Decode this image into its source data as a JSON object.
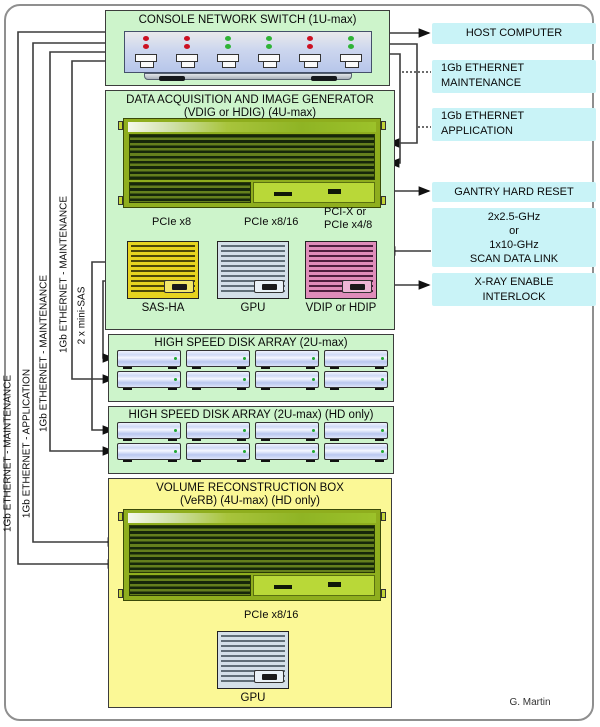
{
  "console_switch": {
    "title": "CONSOLE NETWORK SWITCH (1U-max)",
    "ports": [
      "red",
      "red",
      "green",
      "green",
      "red",
      "green"
    ]
  },
  "daq": {
    "title": "DATA ACQUISITION AND IMAGE GENERATOR",
    "subtitle": "(VDIG or HDIG) (4U-max)",
    "bus_sas": "PCIe x8",
    "bus_gpu": "PCIe x8/16",
    "bus_vdip_1": "PCI-X or",
    "bus_vdip_2": "PCIe x4/8",
    "card_sas": "SAS-HA",
    "card_gpu": "GPU",
    "card_vdip": "VDIP or HDIP"
  },
  "disk_array_1": {
    "title": "HIGH SPEED DISK ARRAY (2U-max)",
    "drive_count": 8
  },
  "disk_array_2": {
    "title": "HIGH SPEED DISK ARRAY (2U-max) (HD only)",
    "drive_count": 8
  },
  "verb": {
    "title": "VOLUME RECONSTRUCTION BOX",
    "subtitle": "(VeRB) (4U-max) (HD only)",
    "bus_gpu": "PCIe x8/16",
    "card_gpu": "GPU"
  },
  "right_panel": {
    "host": "HOST COMPUTER",
    "eth_maintenance_1": "1Gb ETHERNET",
    "eth_maintenance_2": "MAINTENANCE",
    "eth_application_1": "1Gb ETHERNET",
    "eth_application_2": "APPLICATION",
    "gantry": "GANTRY HARD RESET",
    "scan_1": "2x2.5-GHz",
    "scan_2": "or",
    "scan_3": "1x10-GHz",
    "scan_4": "SCAN DATA LINK",
    "xray_1": "X-RAY ENABLE",
    "xray_2": "INTERLOCK"
  },
  "left_labels": {
    "line1": "1Gb ETHERNET - MAINTENANCE",
    "line2": "1Gb ETHERNET - APPLICATION",
    "line3": "1Gb ETHERNET - MAINTENANCE",
    "line4": "1Gb ETHERNET - MAINTENANCE",
    "minisas": "2 x mini-SAS"
  },
  "credit": "G. Martin",
  "colors": {
    "panel_green": "#cdf4cb",
    "panel_yellow": "#fbf896",
    "label_cyan": "#c9f3f7",
    "led_red": "#cc1122",
    "led_green": "#2fb336",
    "card_sas": "#e6d31f",
    "card_gpu": "#d3dfe8",
    "card_vdip": "#df8cba"
  }
}
